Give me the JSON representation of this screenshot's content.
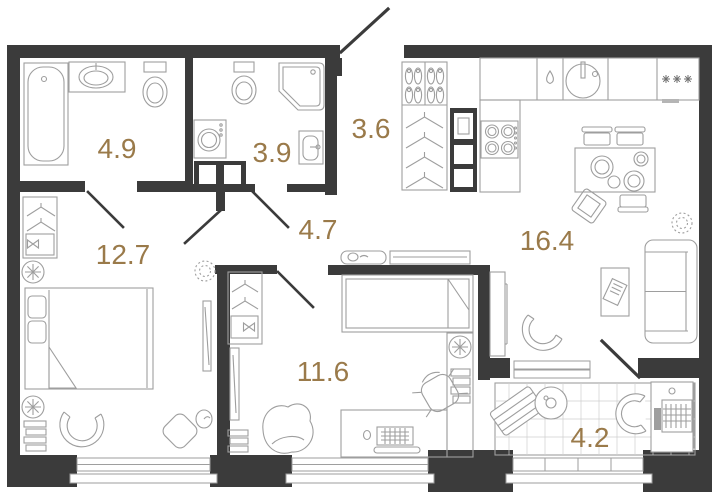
{
  "floor_plan": {
    "rooms": [
      {
        "name": "bathroom",
        "area": "4.9"
      },
      {
        "name": "shower-room",
        "area": "3.9"
      },
      {
        "name": "entry-hall",
        "area": "3.6"
      },
      {
        "name": "corridor",
        "area": "4.7"
      },
      {
        "name": "bedroom",
        "area": "12.7"
      },
      {
        "name": "kitchen-living-room",
        "area": "16.4"
      },
      {
        "name": "bedroom-2",
        "area": "11.6"
      },
      {
        "name": "balcony",
        "area": "4.2"
      }
    ],
    "colors": {
      "wall": "#3b3b3b",
      "furniture_line": "#9e9e9e",
      "room_label": "#9a7a4a",
      "background": "#ffffff"
    }
  }
}
